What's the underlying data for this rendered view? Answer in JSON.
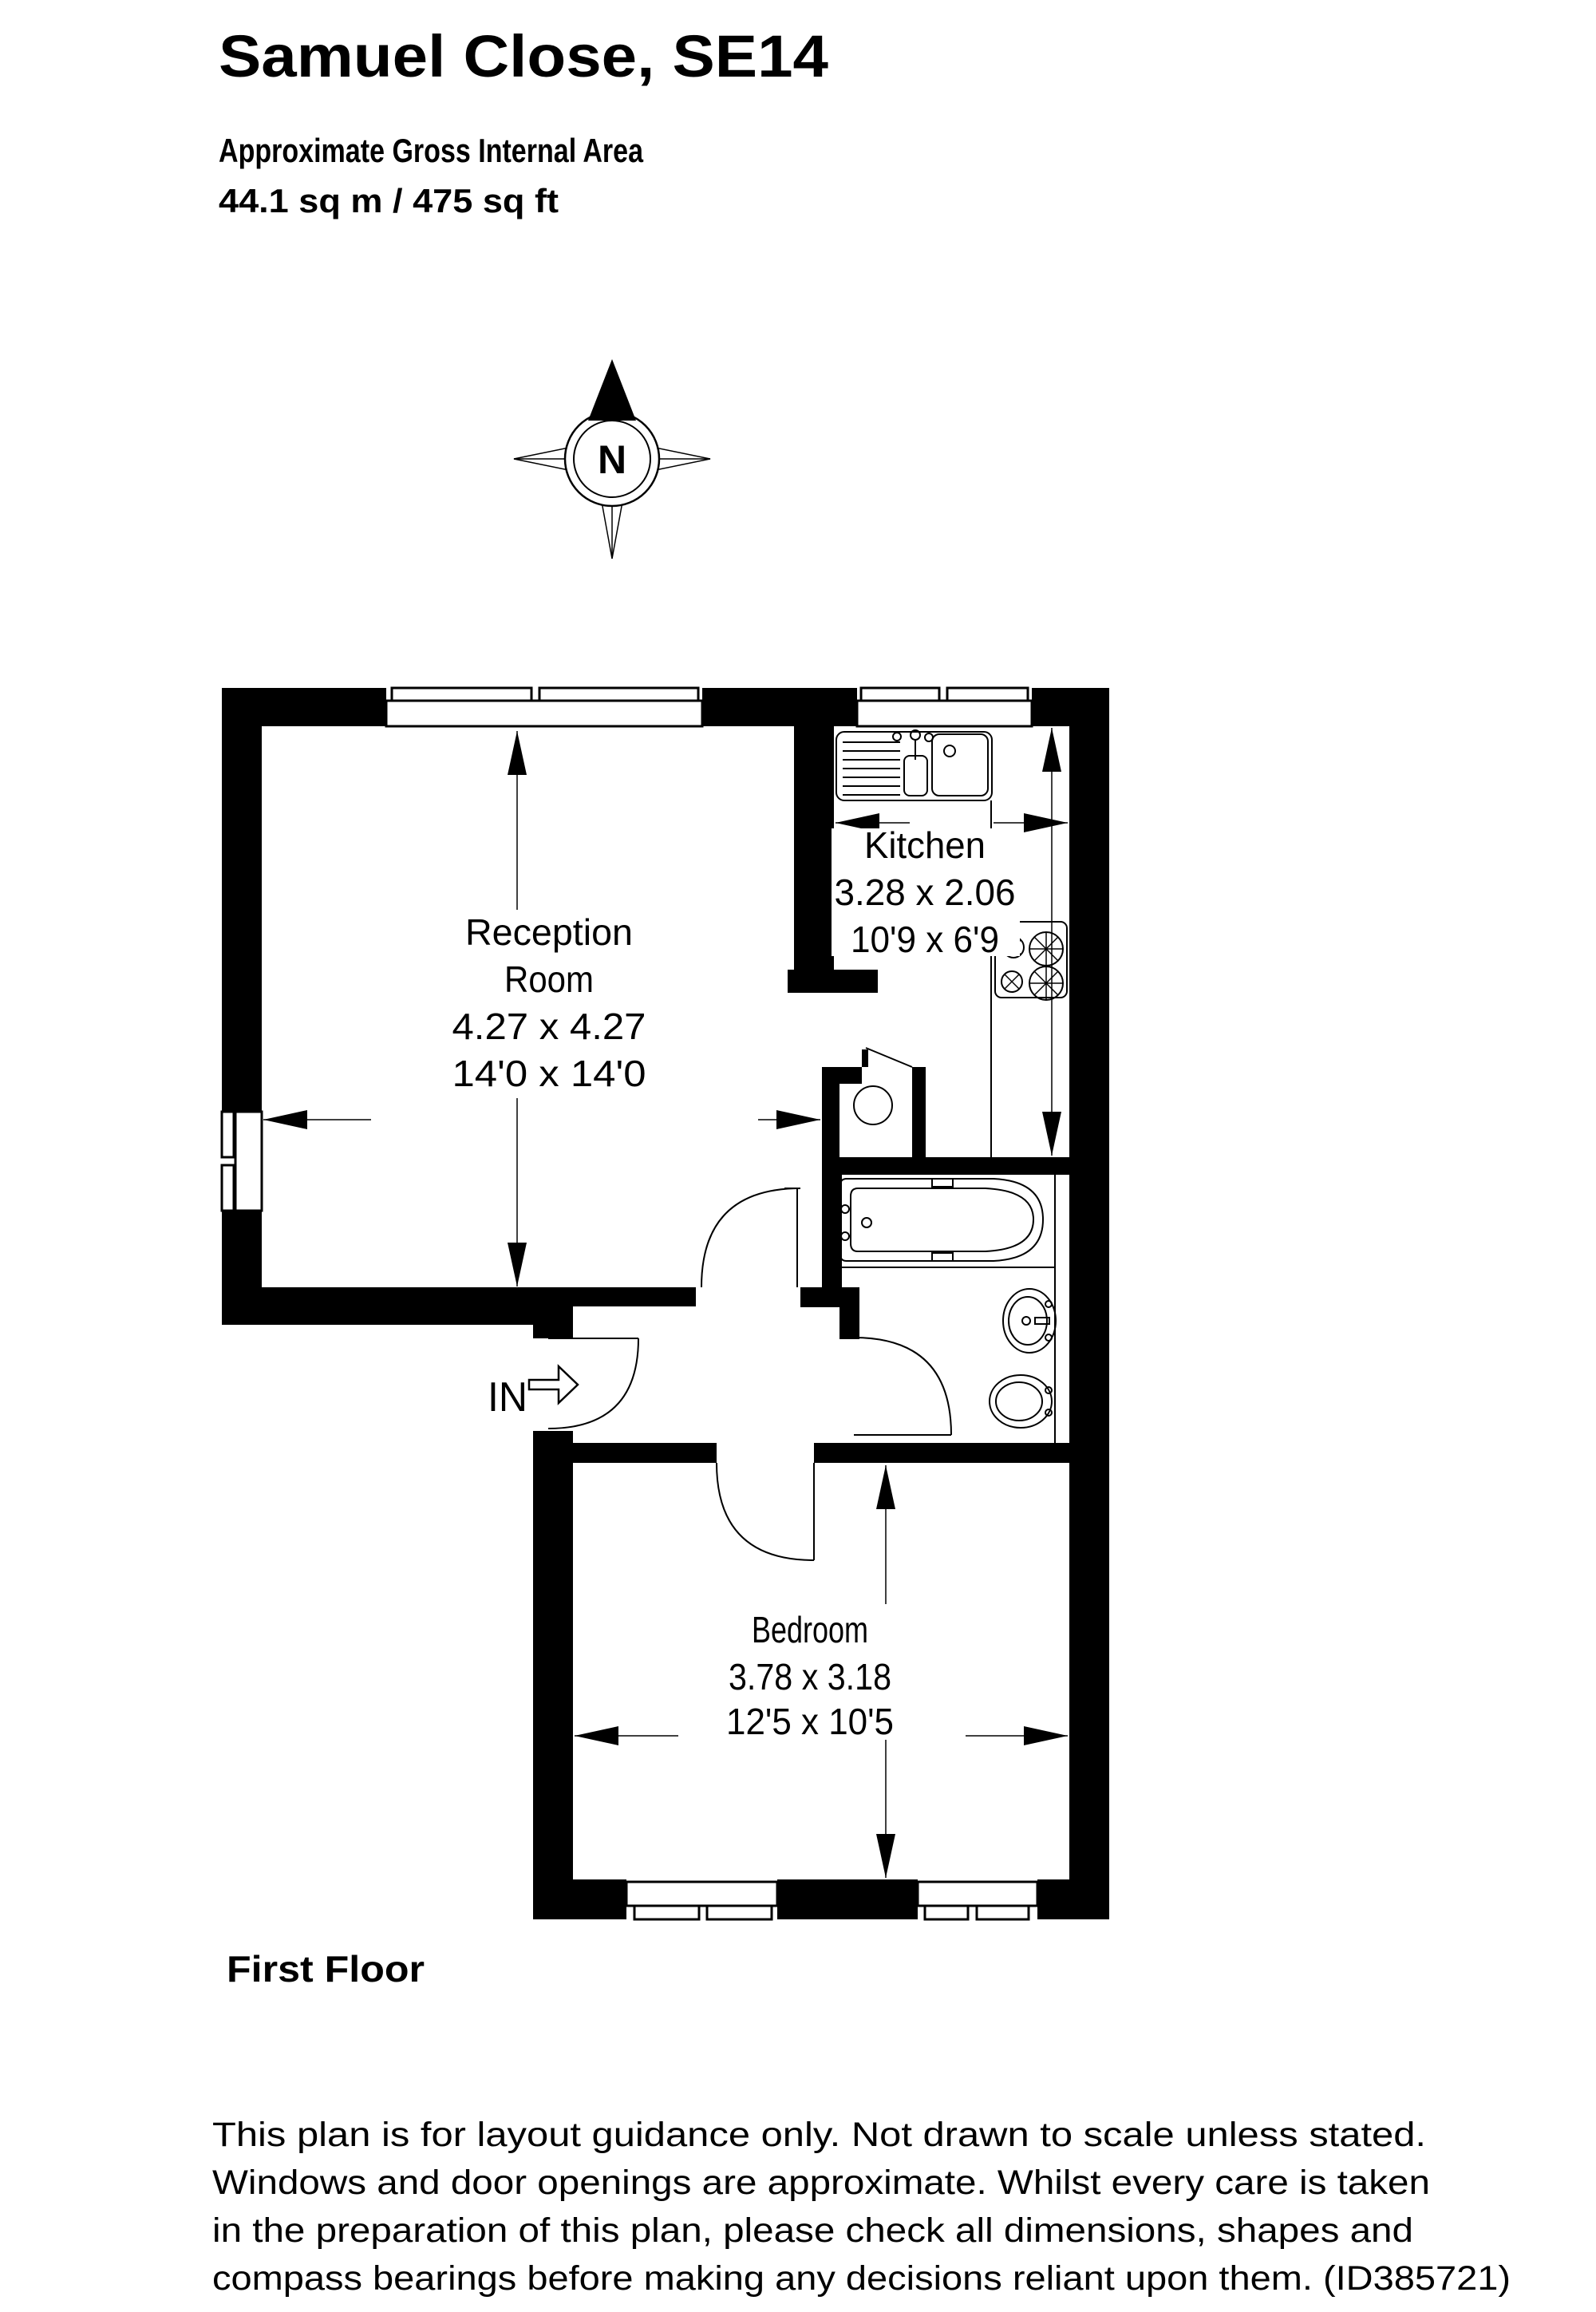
{
  "colors": {
    "walls": "#000000",
    "background": "#ffffff",
    "text": "#000000"
  },
  "header": {
    "title": "Samuel Close, SE14",
    "subtitle": "Approximate Gross Internal Area",
    "area": "44.1 sq m / 475 sq ft"
  },
  "compass": {
    "label": "N"
  },
  "entrance": {
    "label": "IN"
  },
  "rooms": [
    {
      "name": "Reception Room",
      "label_line1": "Reception",
      "label_line2": "Room",
      "dimensions_metric": "4.27 x 4.27",
      "dimensions_imperial": "14'0 x 14'0"
    },
    {
      "name": "Kitchen",
      "label_line1": "Kitchen",
      "dimensions_metric": "3.28 x 2.06",
      "dimensions_imperial": "10'9 x 6'9"
    },
    {
      "name": "Bedroom",
      "label_line1": "Bedroom",
      "dimensions_metric": "3.78 x 3.18",
      "dimensions_imperial": "12'5 x 10'5"
    }
  ],
  "fixtures": [
    "kitchen-sink",
    "hob",
    "boiler-cylinder",
    "bath",
    "washbasin",
    "toilet"
  ],
  "floor_label": "First Floor",
  "disclaimer": {
    "line1": "This plan is for layout guidance only. Not drawn to scale unless stated.",
    "line2": "Windows and door openings are approximate. Whilst every care is taken",
    "line3": "in the preparation of this plan, please check all dimensions, shapes and",
    "line4": "compass bearings before making any decisions reliant upon them. (ID385721)"
  }
}
